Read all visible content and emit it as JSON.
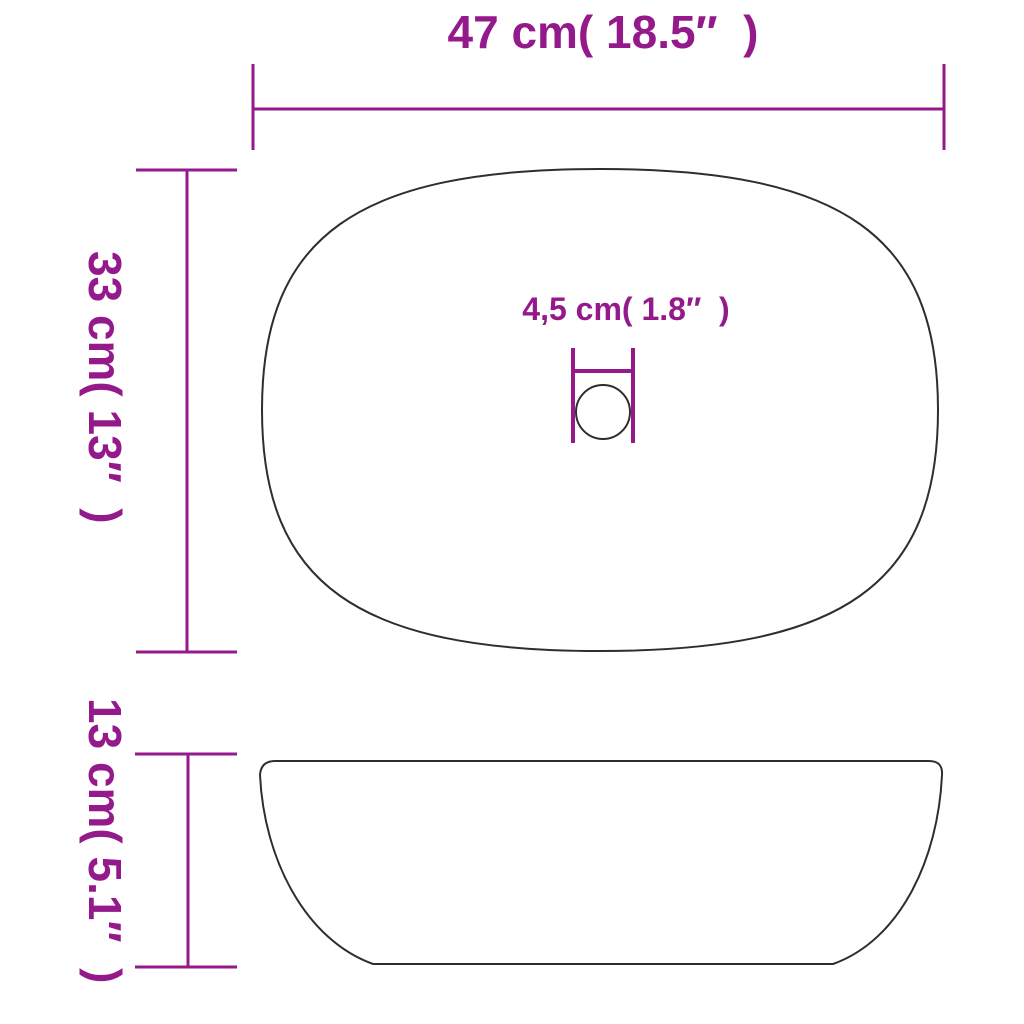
{
  "labels": {
    "top_width": "47 cm( 18.5″  )",
    "basin_depth": "33 cm( 13″  )",
    "drain_diameter": "4,5 cm( 1.8″  )",
    "basin_height": "13 cm( 5.1″  )"
  },
  "measurements": [
    {
      "name": "width",
      "cm": 47,
      "inches": 18.5
    },
    {
      "name": "depth",
      "cm": 33,
      "inches": 13
    },
    {
      "name": "drain_diameter",
      "cm": 4.5,
      "inches": 1.8
    },
    {
      "name": "height",
      "cm": 13,
      "inches": 5.1
    }
  ],
  "colors": {
    "dimension_accent": "#941A8C",
    "shape_outline": "#2e2e2e",
    "background": "#ffffff"
  }
}
